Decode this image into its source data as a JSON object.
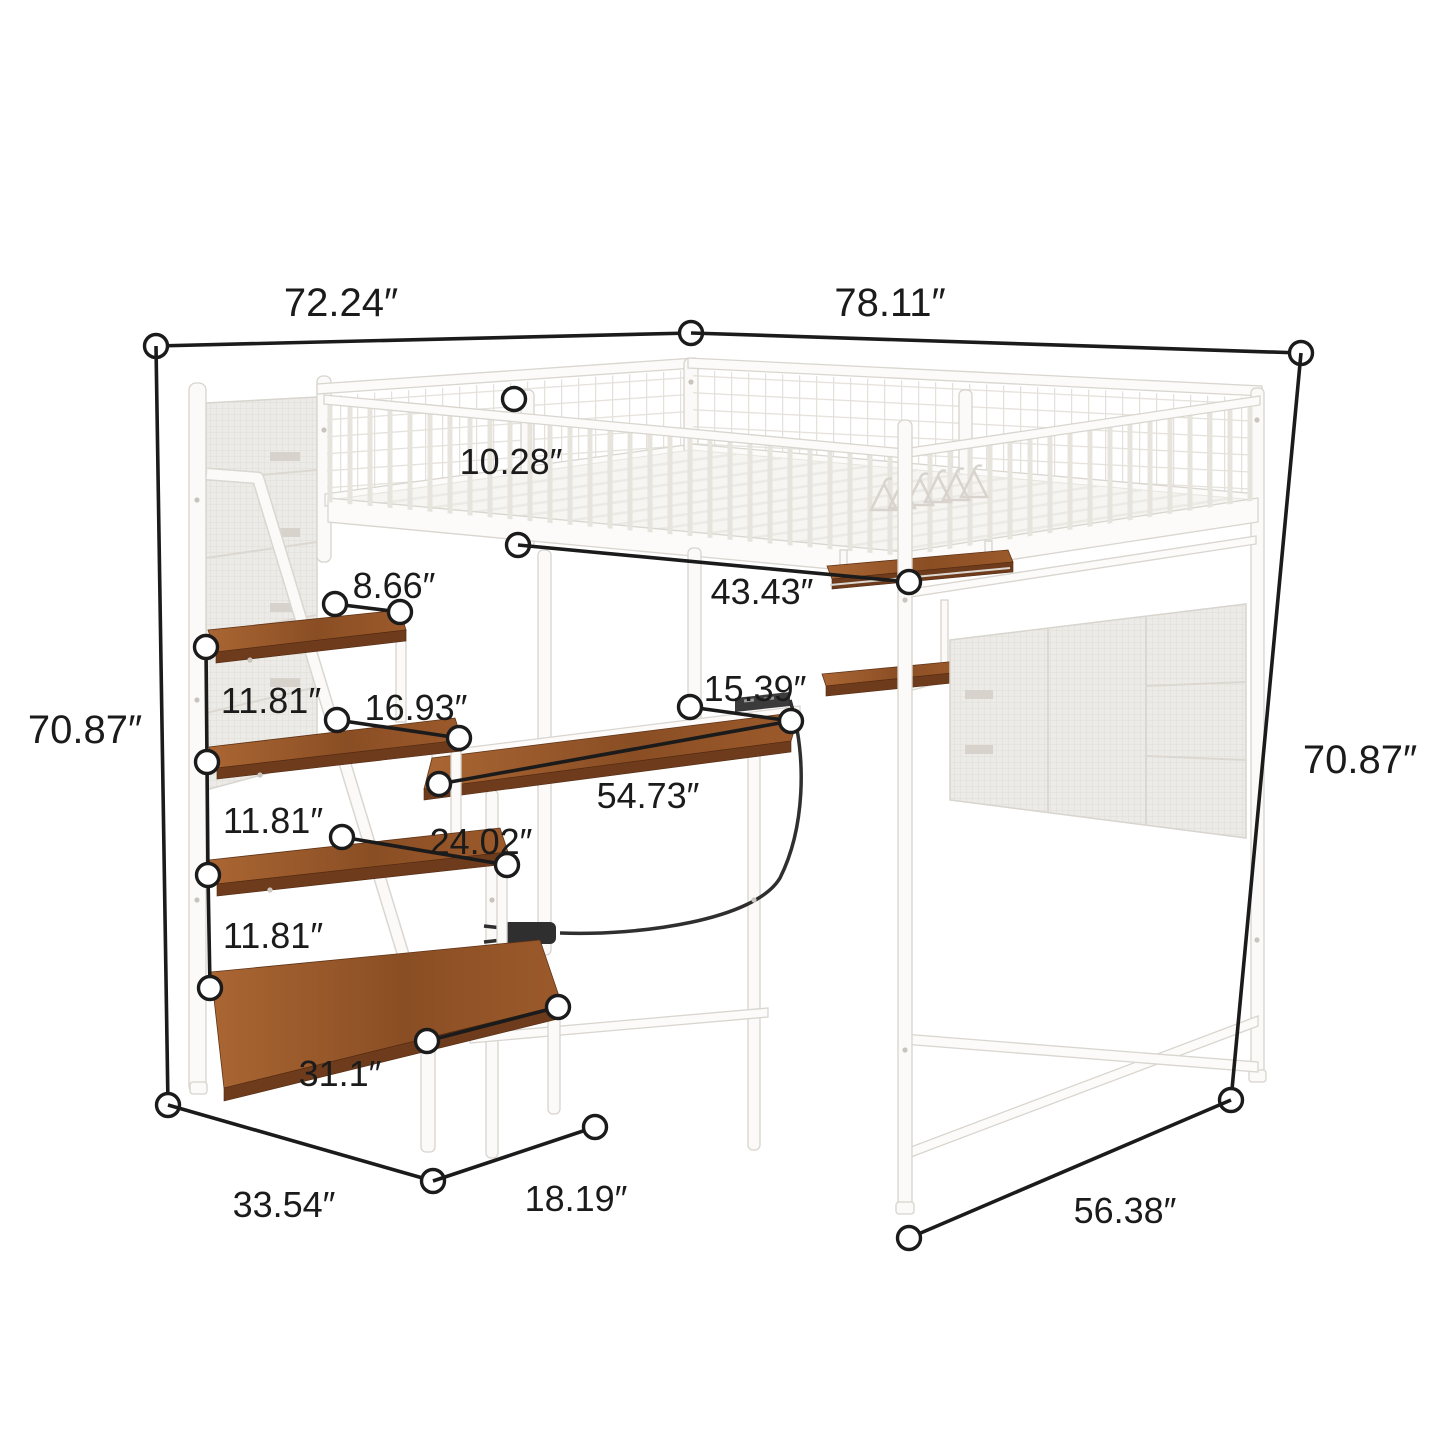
{
  "meta": {
    "type": "product-dimension-diagram",
    "subject": "White metal loft bed with guardrails, storage staircase shelves, built-in desk with power outlet, hanging shelves and mesh storage panels",
    "unit": "inches",
    "background": "#ffffff"
  },
  "colors": {
    "dimension_line": "#1b1b1b",
    "label_text": "#1b1b1b",
    "metal_frame": "#fbfaf8",
    "frame_outline": "#d8d4ce",
    "wood_shelf": "#8a4e24",
    "mesh_fabric": "#edebe7",
    "power_cord": "#2f2f2f"
  },
  "dims": {
    "top_width": "72.24″",
    "top_depth": "78.11″",
    "height_left": "70.87″",
    "height_right": "70.87″",
    "guardrail_height": "10.28″",
    "step_shelf_1_depth": "8.66″",
    "underbed_width": "43.43″",
    "shelf_gap_1": "11.81″",
    "shelf_gap_2": "11.81″",
    "shelf_gap_3": "11.81″",
    "step_shelf_2_width": "16.93″",
    "desk_depth": "15.39″",
    "desk_length": "54.73″",
    "step_shelf_3_width": "24.02″",
    "step_shelf_4_width": "31.1″",
    "stairs_base_depth": "33.54″",
    "stairs_base_width": "18.19″",
    "bed_base_depth": "56.38″"
  }
}
